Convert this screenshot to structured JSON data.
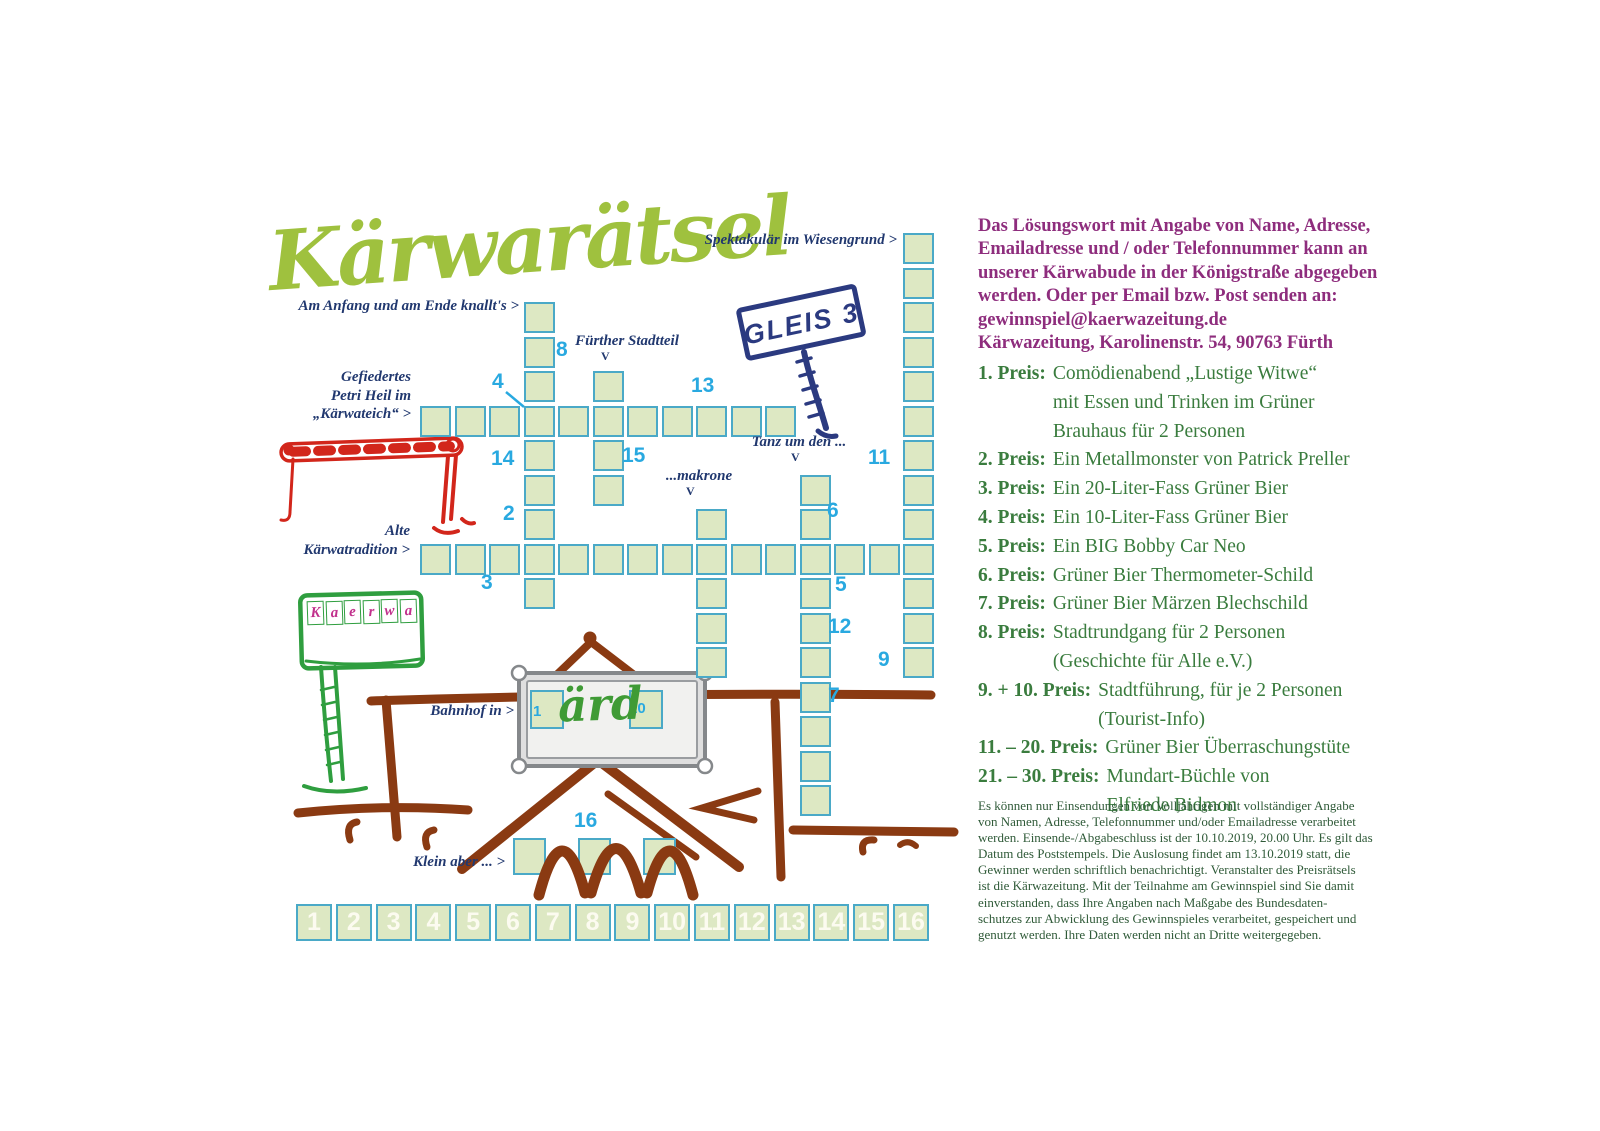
{
  "title": "Kärwarätsel",
  "grid": {
    "layout": {
      "origin_x": 420,
      "origin_y": 233,
      "pitch": 34.5,
      "cell_size": 31
    },
    "cells": [
      [
        0,
        5
      ],
      [
        1,
        5
      ],
      [
        2,
        5
      ],
      [
        3,
        5
      ],
      [
        4,
        5
      ],
      [
        5,
        5
      ],
      [
        6,
        5
      ],
      [
        7,
        5
      ],
      [
        8,
        5
      ],
      [
        9,
        5
      ],
      [
        10,
        5
      ],
      [
        0,
        9
      ],
      [
        1,
        9
      ],
      [
        2,
        9
      ],
      [
        3,
        9
      ],
      [
        4,
        9
      ],
      [
        5,
        9
      ],
      [
        6,
        9
      ],
      [
        7,
        9
      ],
      [
        8,
        9
      ],
      [
        9,
        9
      ],
      [
        10,
        9
      ],
      [
        11,
        9
      ],
      [
        12,
        9
      ],
      [
        13,
        9
      ],
      [
        14,
        9
      ],
      [
        3,
        2
      ],
      [
        3,
        3
      ],
      [
        3,
        4
      ],
      [
        3,
        6
      ],
      [
        3,
        7
      ],
      [
        3,
        8
      ],
      [
        3,
        10
      ],
      [
        5,
        4
      ],
      [
        5,
        6
      ],
      [
        5,
        7
      ],
      [
        8,
        8
      ],
      [
        8,
        10
      ],
      [
        8,
        11
      ],
      [
        8,
        12
      ],
      [
        11,
        7
      ],
      [
        11,
        8
      ],
      [
        11,
        10
      ],
      [
        11,
        11
      ],
      [
        11,
        12
      ],
      [
        11,
        13
      ],
      [
        11,
        14
      ],
      [
        11,
        15
      ],
      [
        11,
        16
      ],
      [
        14,
        0
      ],
      [
        14,
        1
      ],
      [
        14,
        2
      ],
      [
        14,
        3
      ],
      [
        14,
        4
      ],
      [
        14,
        5
      ],
      [
        14,
        6
      ],
      [
        14,
        7
      ],
      [
        14,
        8
      ],
      [
        14,
        10
      ],
      [
        14,
        11
      ],
      [
        14,
        12
      ]
    ],
    "free_cells": [
      {
        "x": 530,
        "y": 690,
        "w": 34,
        "h": 39
      },
      {
        "x": 629,
        "y": 690,
        "w": 34,
        "h": 39
      },
      {
        "x": 513,
        "y": 838,
        "w": 33,
        "h": 37
      },
      {
        "x": 578,
        "y": 838,
        "w": 33,
        "h": 37
      },
      {
        "x": 643,
        "y": 838,
        "w": 33,
        "h": 37
      }
    ],
    "markers": [
      {
        "n": "1",
        "x": 533,
        "y": 704,
        "small": true
      },
      {
        "n": "2",
        "x": 503,
        "y": 503
      },
      {
        "n": "3",
        "x": 481,
        "y": 572
      },
      {
        "n": "4",
        "x": 492,
        "y": 371
      },
      {
        "n": "5",
        "x": 835,
        "y": 574
      },
      {
        "n": "6",
        "x": 827,
        "y": 500
      },
      {
        "n": "7",
        "x": 828,
        "y": 685
      },
      {
        "n": "8",
        "x": 556,
        "y": 339
      },
      {
        "n": "9",
        "x": 878,
        "y": 649
      },
      {
        "n": "10",
        "x": 629,
        "y": 701,
        "small": true
      },
      {
        "n": "11",
        "x": 868,
        "y": 447
      },
      {
        "n": "12",
        "x": 828,
        "y": 616
      },
      {
        "n": "13",
        "x": 691,
        "y": 375
      },
      {
        "n": "14",
        "x": 491,
        "y": 448
      },
      {
        "n": "15",
        "x": 622,
        "y": 445
      },
      {
        "n": "16",
        "x": 574,
        "y": 810
      }
    ],
    "clues": [
      {
        "id": "spektakulaer",
        "anchor": "right",
        "x": 897,
        "y": 231,
        "lines": [
          "Spektakulär im Wiesengrund >"
        ]
      },
      {
        "id": "knallts",
        "anchor": "right",
        "x": 519,
        "y": 297,
        "lines": [
          "Am Anfang und am Ende knallt's >"
        ]
      },
      {
        "id": "fuerther-stadtteil",
        "anchor": "center",
        "x": 627,
        "y": 332,
        "lines": [
          "Fürther Stadtteil"
        ],
        "v": {
          "x": 601,
          "y": 349
        }
      },
      {
        "id": "gefiedertes",
        "anchor": "right",
        "x": 411,
        "y": 368,
        "lines": [
          "Gefiedertes",
          "Petri Heil im",
          "„Kärwateich“ >"
        ]
      },
      {
        "id": "tanz",
        "anchor": "center",
        "x": 799,
        "y": 433,
        "lines": [
          "Tanz um den ..."
        ],
        "v": {
          "x": 791,
          "y": 450
        }
      },
      {
        "id": "makrone",
        "anchor": "center",
        "x": 699,
        "y": 467,
        "lines": [
          "...makrone"
        ],
        "v": {
          "x": 686,
          "y": 484
        }
      },
      {
        "id": "alte-tradition",
        "anchor": "right",
        "x": 410,
        "y": 522,
        "lines": [
          "Alte",
          "Kärwatradition >"
        ]
      },
      {
        "id": "bahnhof",
        "anchor": "right",
        "x": 514,
        "y": 702,
        "lines": [
          "Bahnhof in >"
        ]
      },
      {
        "id": "klein-aber",
        "anchor": "right",
        "x": 505,
        "y": 853,
        "lines": [
          "Klein aber ... >"
        ]
      }
    ]
  },
  "solution_cells": [
    "1",
    "2",
    "3",
    "4",
    "5",
    "6",
    "7",
    "8",
    "9",
    "10",
    "11",
    "12",
    "13",
    "14",
    "15",
    "16"
  ],
  "signs": {
    "gleis": "GLEIS 3",
    "kaerwa": [
      "K",
      "a",
      "e",
      "r",
      "w",
      "a"
    ],
    "station_text": "ärd"
  },
  "info_panel": {
    "submission_lines": [
      "Das Lösungswort mit Angabe von Name, Adresse,",
      "Emailadresse und / oder Telefonnummer kann an",
      "unserer Kärwabude in der Königstraße abgegeben",
      "werden. Oder per Email bzw. Post senden an:",
      "gewinnspiel@kaerwazeitung.de",
      "Kärwazeitung, Karolinenstr. 54, 90763 Fürth"
    ],
    "prizes": [
      {
        "label": "1. Preis:",
        "lines": [
          "Comödienabend „Lustige Witwe“",
          "mit Essen und Trinken im Grüner",
          "Brauhaus für 2 Personen"
        ]
      },
      {
        "label": "2. Preis:",
        "lines": [
          "Ein Metallmonster von Patrick Preller"
        ]
      },
      {
        "label": "3. Preis:",
        "lines": [
          "Ein 20-Liter-Fass Grüner Bier"
        ]
      },
      {
        "label": "4. Preis:",
        "lines": [
          "Ein 10-Liter-Fass Grüner Bier"
        ]
      },
      {
        "label": "5. Preis:",
        "lines": [
          "Ein BIG Bobby Car Neo"
        ]
      },
      {
        "label": "6. Preis:",
        "lines": [
          "Grüner Bier Thermometer-Schild"
        ]
      },
      {
        "label": "7. Preis:",
        "lines": [
          "Grüner Bier Märzen Blechschild"
        ]
      },
      {
        "label": "8. Preis:",
        "lines": [
          "Stadtrundgang für 2 Personen",
          "(Geschichte für Alle e.V.)"
        ]
      },
      {
        "label": "9. + 10. Preis:",
        "lines": [
          "Stadtführung, für je 2 Personen",
          "(Tourist-Info)"
        ]
      },
      {
        "label": "11. – 20. Preis:",
        "lines": [
          "Grüner Bier Überraschungstüte"
        ]
      },
      {
        "label": "21. – 30. Preis:",
        "lines": [
          "Mundart-Büchle von",
          "Elfriede Bidmon"
        ]
      }
    ],
    "fine_print_lines": [
      "Es können nur Einsendungen von Volljährigen mit vollständiger Angabe",
      "von Namen, Adresse, Telefonnummer und/oder Emailadresse verarbeitet",
      "werden. Einsende-/Abgabeschluss ist der 10.10.2019, 20.00 Uhr. Es gilt das",
      "Datum des Poststempels. Die Auslosung findet am 13.10.2019 statt, die",
      "Gewinner werden schriftlich benachrichtigt. Veranstalter des Preisrätsels",
      "ist die Kärwazeitung. Mit der Teilnahme am Gewinnspiel sind Sie damit",
      "einverstanden, dass Ihre Angaben nach Maßgabe des Bundesdaten-",
      "schutzes zur Abwicklung des Gewinnspieles verarbeitet, gespeichert und",
      "genutzt werden. Ihre Daten werden nicht an Dritte weitergegeben."
    ]
  },
  "colors": {
    "title_green": "#9fc13e",
    "cell_fill": "#dde8c3",
    "cell_border": "#4aa9c7",
    "marker_blue": "#29a9e0",
    "clue_navy": "#21386f",
    "sign_navy": "#2b3a80",
    "barrier_red": "#d2261b",
    "kaerwa_green": "#2f9e3f",
    "letter_magenta": "#c1308c",
    "house_brown": "#8a3a12",
    "submission_purple": "#8e2d7d",
    "prize_green": "#3a7c3e",
    "fine_print_green": "#2f5a38"
  }
}
